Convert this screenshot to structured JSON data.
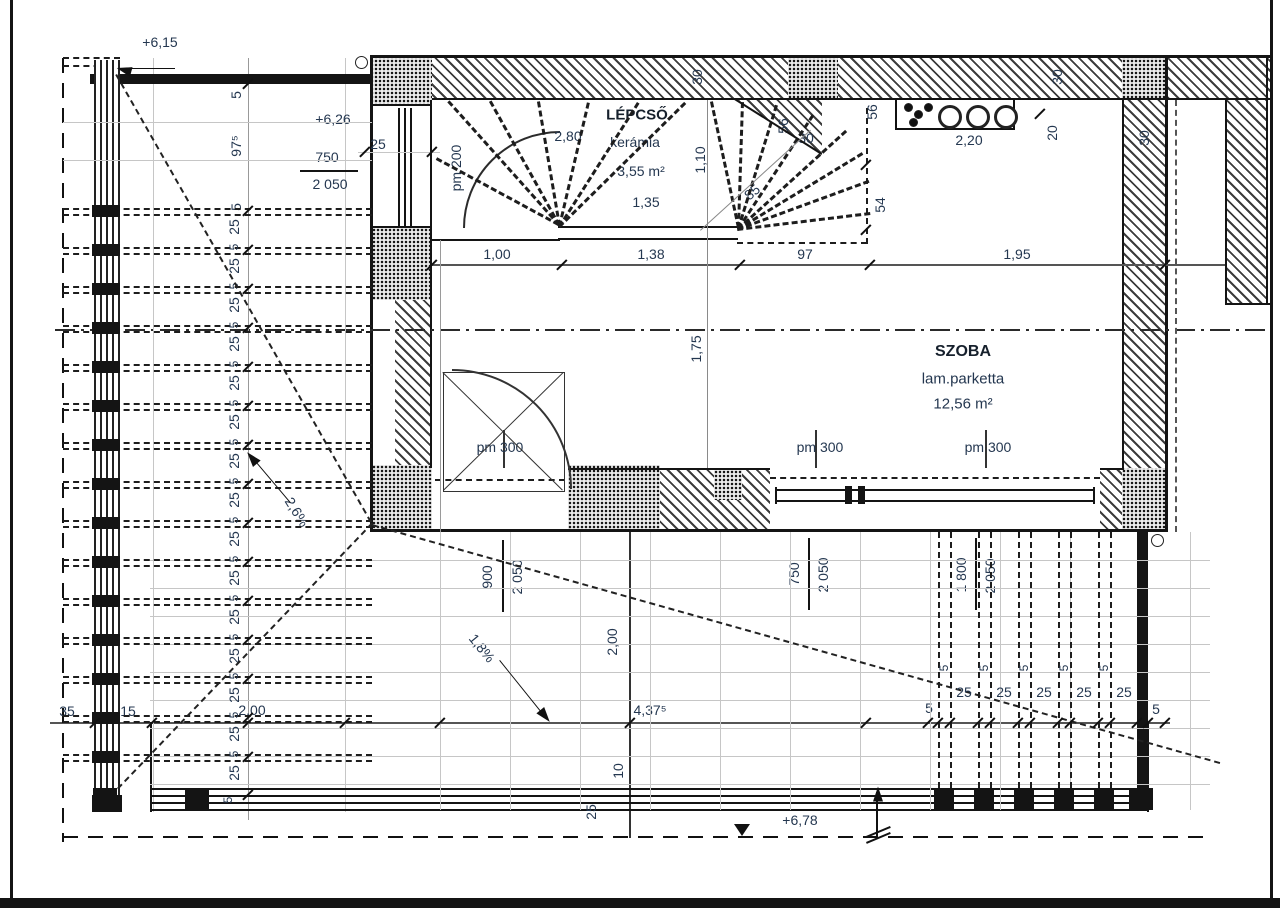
{
  "drawing": {
    "levels": {
      "upper_left": "+6,15",
      "stair_door": "+6,26",
      "terrace": "+6,78"
    },
    "rooms": {
      "stair": {
        "name": "LÉPCSŐ",
        "finish": "kerámia",
        "area": "3,55 m²",
        "tread_width": "1,35"
      },
      "room": {
        "name": "SZOBA",
        "finish": "lam.parketta",
        "area": "12,56 m²"
      }
    },
    "sill_heights": {
      "stair_window": "pm 200",
      "hall_door": "pm 300",
      "room_window_1": "pm 300",
      "room_window_2": "pm 300"
    },
    "window_marks": {
      "stair_window": {
        "w": "750",
        "h": "2 050",
        "jamb": "25"
      },
      "hall_door": {
        "w": "900",
        "h": "2 050"
      },
      "room_window_1": {
        "w": "750",
        "h": "2 050"
      },
      "room_window_2": {
        "w": "1 800",
        "h": "2 050"
      }
    },
    "dims": {
      "row_top": [
        "1,00",
        "1,38",
        "97",
        "1,95"
      ],
      "stair": {
        "run": "2,80",
        "width": "1,10",
        "d85": "85",
        "d30": "30",
        "d56_left": "56",
        "d56_right": "56",
        "d54": "54"
      },
      "walls": {
        "top_left": "30",
        "top_right": "30",
        "right": "30"
      },
      "radiator": {
        "length": "2,20",
        "gap": "20"
      },
      "room_depth": "1,75",
      "left_chain": {
        "head": [
          "5",
          "97⁵",
          "5"
        ],
        "gap": "25",
        "batten": "5",
        "tail": "5"
      },
      "bottom": {
        "left": [
          "35",
          "15",
          "2,00"
        ],
        "length": "4,37⁵",
        "depth": "2,00",
        "pre": "5",
        "gap": "25",
        "batten": "5",
        "post": "5",
        "offset": "10",
        "edge": "25"
      }
    },
    "slopes": {
      "left": "2,6%",
      "lower": "1,8%"
    }
  }
}
